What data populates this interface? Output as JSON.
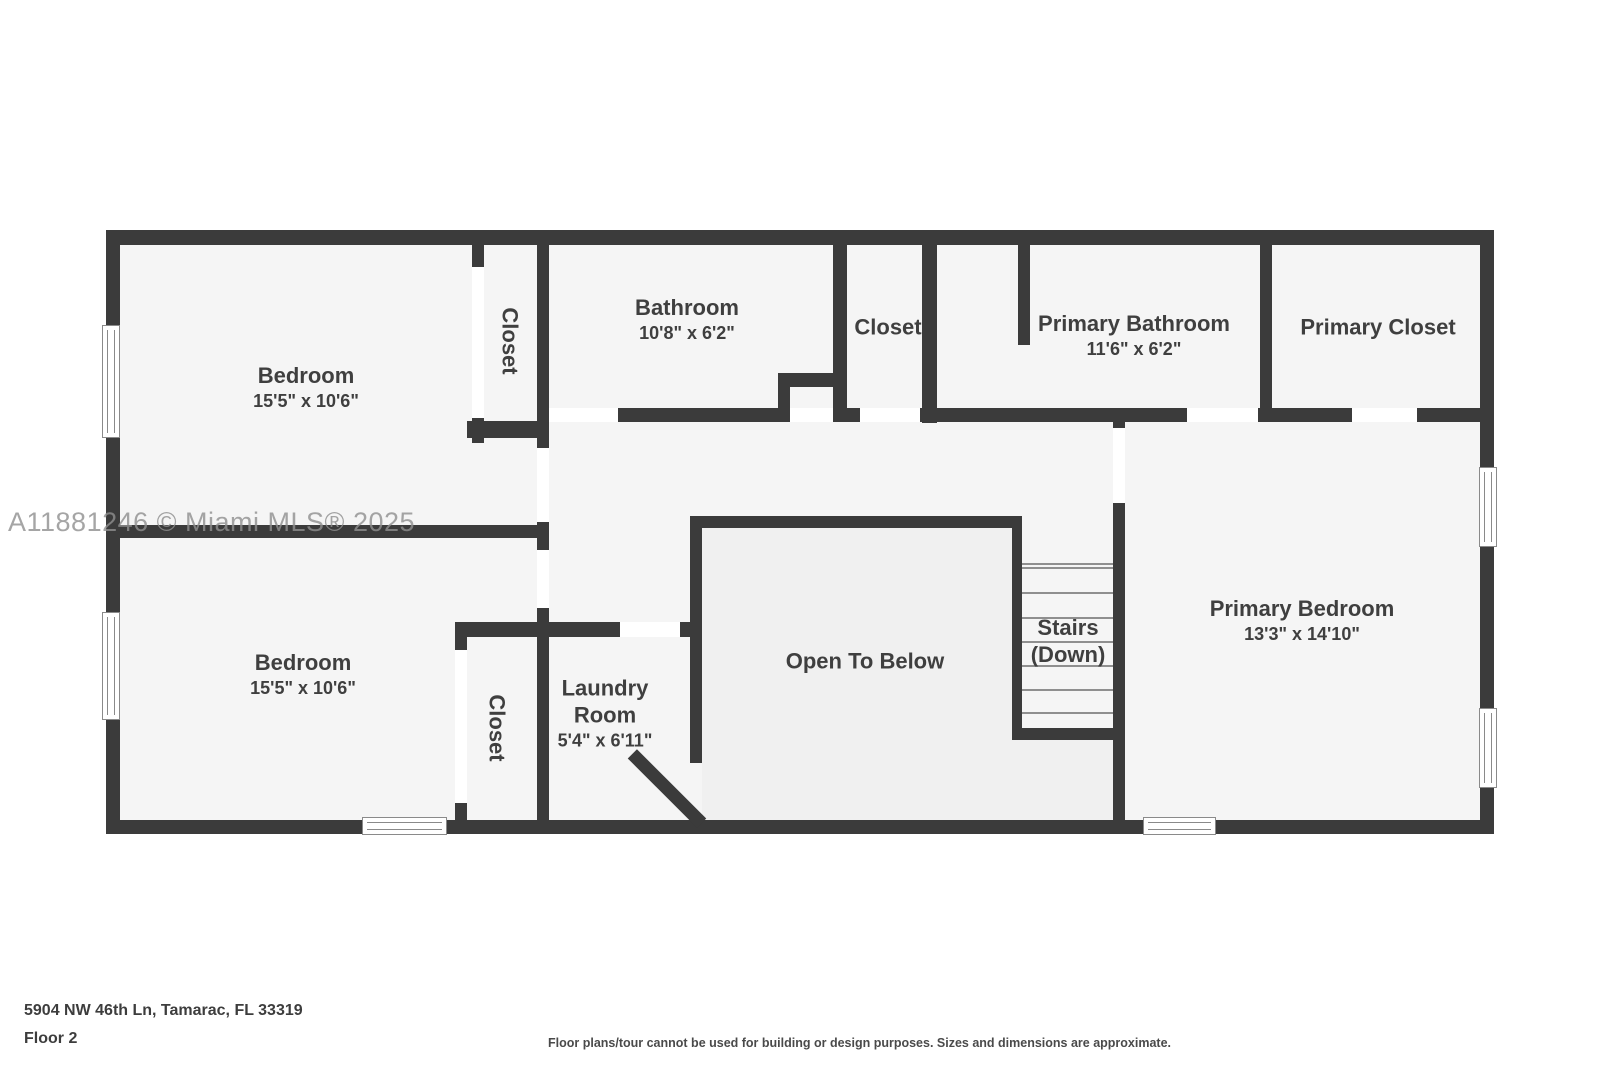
{
  "watermark": {
    "text": "A11881246 © Miami MLS® 2025"
  },
  "footer": {
    "address": "5904 NW 46th Ln, Tamarac, FL 33319",
    "floor": "Floor 2",
    "disclaimer": "Floor plans/tour cannot be used for building or design purposes. Sizes and dimensions are approximate."
  },
  "floorplan": {
    "colors": {
      "wall": "#3b3b3b",
      "floor": "#f5f5f5",
      "open_to_below": "#f0f0f0",
      "door_gap": "#ffffff",
      "label_text": "#3f3f3f"
    },
    "bounds": {
      "x": 106,
      "y": 230,
      "w": 1388,
      "h": 604
    },
    "open_region": {
      "x": 702,
      "y": 528,
      "w": 411,
      "h": 292
    },
    "stairwell_region": {
      "x": 1022,
      "y": 528,
      "w": 91,
      "h": 200
    },
    "walls": [
      [
        106,
        230,
        1388,
        15
      ],
      [
        106,
        820,
        1388,
        14
      ],
      [
        106,
        230,
        14,
        604
      ],
      [
        1480,
        230,
        14,
        604
      ],
      [
        472,
        245,
        12,
        22
      ],
      [
        472,
        418,
        12,
        25
      ],
      [
        537,
        245,
        12,
        203
      ],
      [
        537,
        522,
        12,
        28
      ],
      [
        537,
        608,
        12,
        212
      ],
      [
        833,
        245,
        14,
        177
      ],
      [
        778,
        373,
        12,
        49
      ],
      [
        922,
        245,
        15,
        178
      ],
      [
        1018,
        245,
        12,
        100
      ],
      [
        1260,
        245,
        12,
        175
      ],
      [
        1113,
        417,
        12,
        11
      ],
      [
        1113,
        503,
        12,
        317
      ],
      [
        690,
        516,
        12,
        247
      ],
      [
        1012,
        517,
        10,
        221
      ],
      [
        455,
        622,
        12,
        28
      ],
      [
        455,
        803,
        12,
        17
      ],
      [
        778,
        373,
        69,
        14
      ],
      [
        467,
        421,
        82,
        17
      ],
      [
        618,
        408,
        172,
        14
      ],
      [
        833,
        408,
        27,
        14
      ],
      [
        920,
        408,
        267,
        14
      ],
      [
        1258,
        408,
        94,
        14
      ],
      [
        1417,
        408,
        63,
        14
      ],
      [
        106,
        525,
        443,
        13
      ],
      [
        455,
        622,
        165,
        15
      ],
      [
        680,
        622,
        22,
        15
      ],
      [
        690,
        516,
        332,
        12
      ],
      [
        1012,
        728,
        113,
        12
      ]
    ],
    "diagonal_wall": {
      "x": 618,
      "y": 782,
      "w": 98,
      "h": 13,
      "angle": 45
    },
    "doors": [
      [
        472,
        267,
        12,
        151
      ],
      [
        537,
        448,
        12,
        74
      ],
      [
        537,
        550,
        12,
        58
      ],
      [
        549,
        408,
        69,
        14
      ],
      [
        790,
        408,
        43,
        14
      ],
      [
        860,
        408,
        60,
        14
      ],
      [
        1187,
        408,
        71,
        14
      ],
      [
        1352,
        408,
        65,
        14
      ],
      [
        1113,
        428,
        12,
        75
      ],
      [
        620,
        622,
        60,
        15
      ],
      [
        455,
        650,
        12,
        153
      ]
    ],
    "windows": [
      {
        "x": 102,
        "y": 325,
        "w": 18,
        "h": 113,
        "dir": "v"
      },
      {
        "x": 102,
        "y": 612,
        "w": 18,
        "h": 108,
        "dir": "v"
      },
      {
        "x": 362,
        "y": 817,
        "w": 85,
        "h": 18,
        "dir": "h"
      },
      {
        "x": 1143,
        "y": 817,
        "w": 73,
        "h": 18,
        "dir": "h"
      },
      {
        "x": 1479,
        "y": 467,
        "w": 18,
        "h": 80,
        "dir": "v"
      },
      {
        "x": 1479,
        "y": 708,
        "w": 18,
        "h": 80,
        "dir": "v"
      }
    ],
    "stairs": {
      "x": 1022,
      "w": 91,
      "tread_ys": [
        563,
        567,
        592,
        617,
        641,
        665,
        689,
        712
      ]
    },
    "labels": [
      {
        "key": "bedroom-top",
        "name": "Bedroom",
        "dims": "15'5\" x 10'6\"",
        "cx": 306,
        "cy": 388
      },
      {
        "key": "closet-bedroom-top",
        "name": "Closet",
        "cx": 510,
        "cy": 341,
        "rotate": true
      },
      {
        "key": "bathroom",
        "name": "Bathroom",
        "dims": "10'8\" x 6'2\"",
        "cx": 687,
        "cy": 320
      },
      {
        "key": "closet-hall",
        "name": "Closet",
        "cx": 888,
        "cy": 327
      },
      {
        "key": "primary-bathroom",
        "name": "Primary Bathroom",
        "dims": "11'6\" x 6'2\"",
        "cx": 1134,
        "cy": 336
      },
      {
        "key": "primary-closet",
        "name": "Primary Closet",
        "cx": 1378,
        "cy": 327
      },
      {
        "key": "bedroom-bottom",
        "name": "Bedroom",
        "dims": "15'5\" x 10'6\"",
        "cx": 303,
        "cy": 675
      },
      {
        "key": "closet-bedroom-bottom",
        "name": "Closet",
        "cx": 497,
        "cy": 728,
        "rotate": true
      },
      {
        "key": "laundry",
        "name": "Laundry",
        "name2": "Room",
        "dims": "5'4\" x 6'11\"",
        "cx": 605,
        "cy": 714
      },
      {
        "key": "open-to-below",
        "name": "Open To Below",
        "cx": 865,
        "cy": 661
      },
      {
        "key": "stairs",
        "name": "Stairs",
        "name2": "(Down)",
        "cx": 1068,
        "cy": 641
      },
      {
        "key": "primary-bedroom",
        "name": "Primary Bedroom",
        "dims": "13'3\" x 14'10\"",
        "cx": 1302,
        "cy": 621
      }
    ]
  }
}
